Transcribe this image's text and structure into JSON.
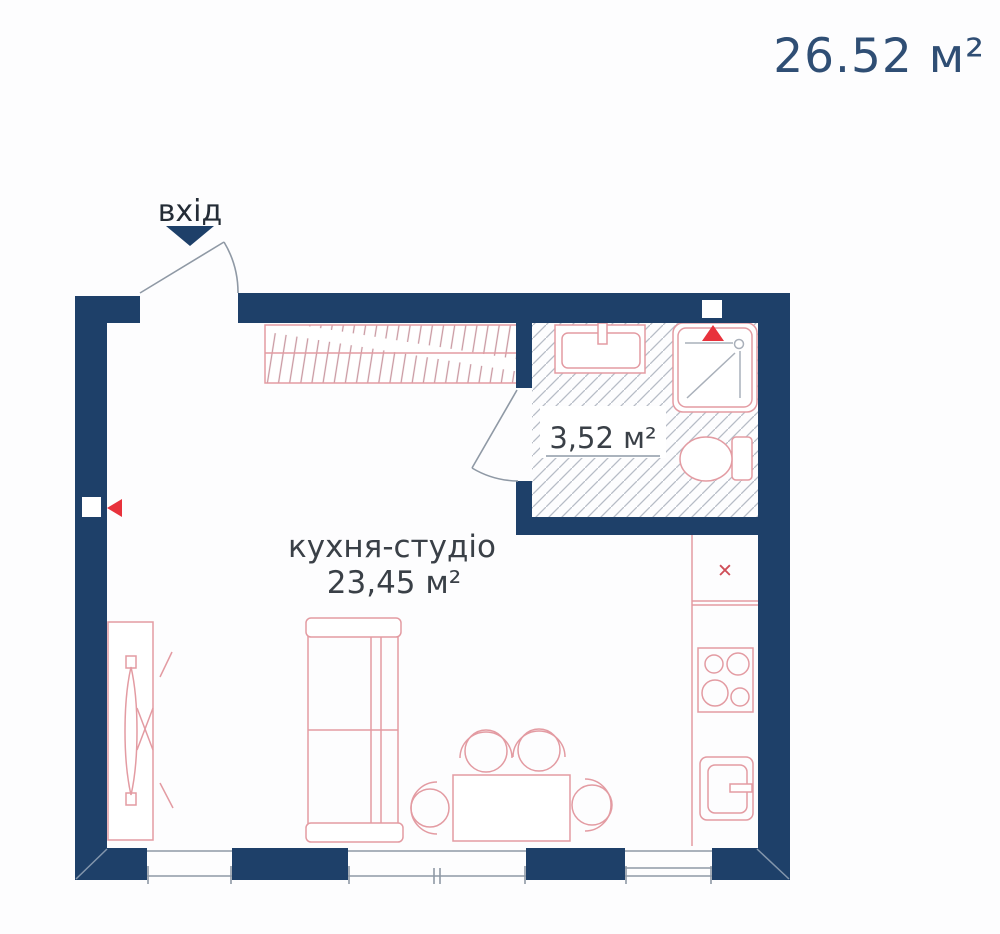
{
  "header": {
    "total_area": "26.52 м²"
  },
  "plan": {
    "entrance_label": "вхід",
    "main_room": {
      "name": "кухня-студіо",
      "area": "23,45 м²"
    },
    "bathroom": {
      "area": "3,52 м²"
    },
    "kitchen": {
      "x_mark": "✕"
    },
    "colors": {
      "wall_navy": "#1e4069",
      "furniture_outline_pink": "#e39ba2",
      "accent_red": "#e8323c",
      "hatch_gray": "#b6bcc6",
      "label_dark": "#3a4047",
      "area_label_navy": "#2f4e74"
    }
  }
}
